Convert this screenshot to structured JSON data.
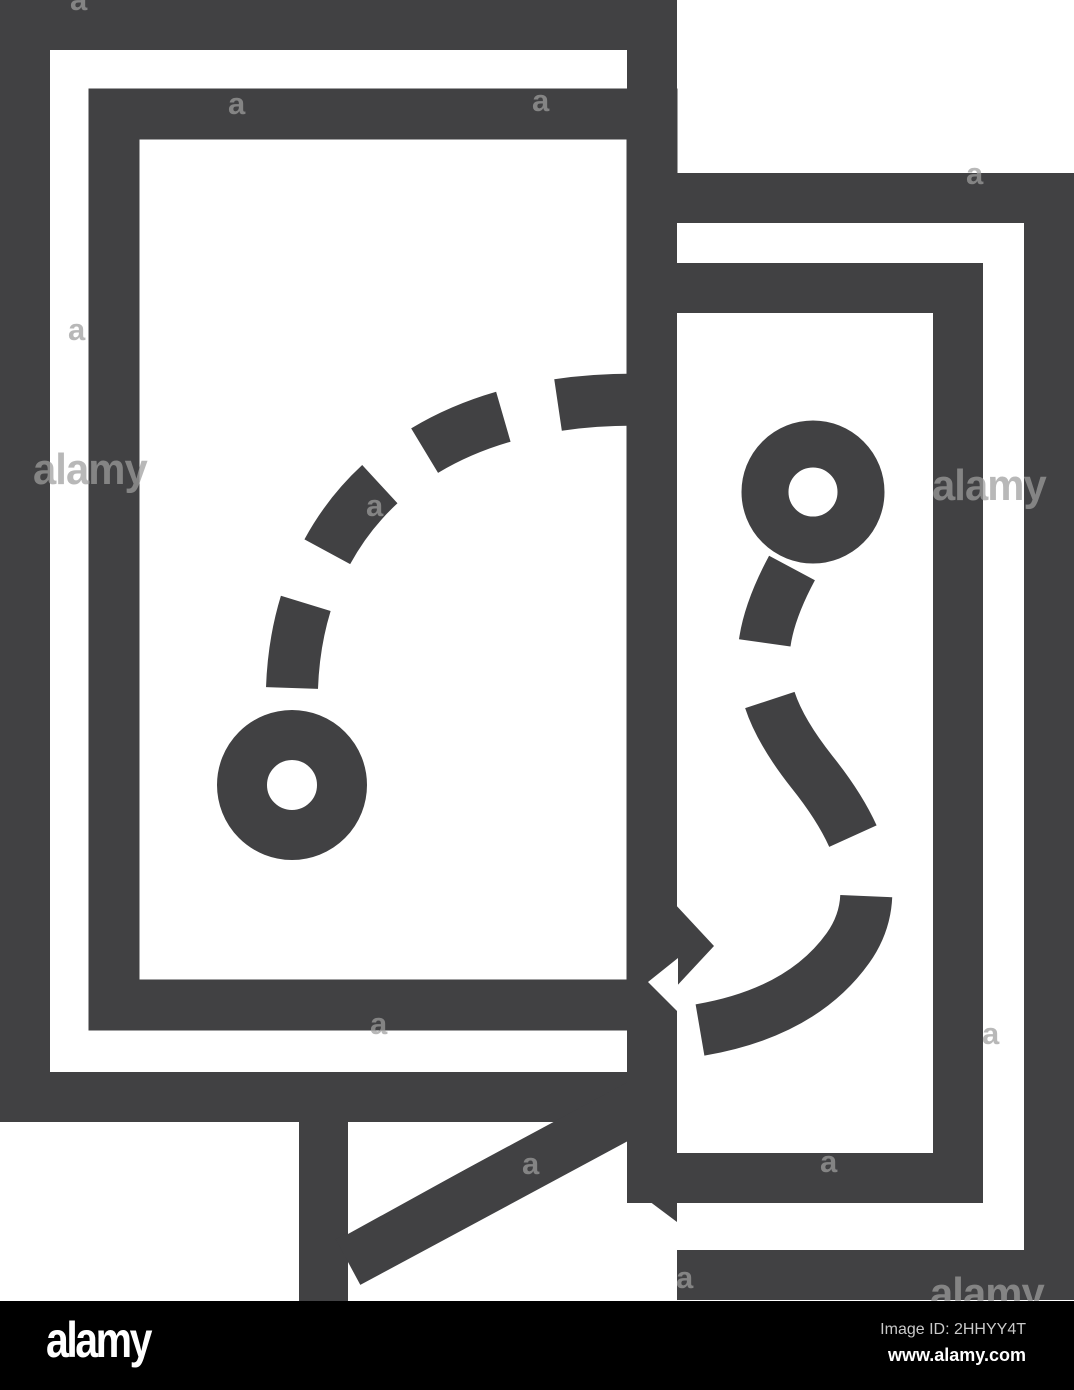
{
  "page": {
    "kind": "stock image preview with watermark",
    "background_color": "#ffffff"
  },
  "icon": {
    "name": "tactic-strategy-icon",
    "description": "Line icon of two overlapping boards with dashed route paths and ring start markers",
    "ink_color": "#414143"
  },
  "watermark": {
    "letter": "a",
    "word": "alamy",
    "color": "#9e9e9e"
  },
  "footer": {
    "background_color": "#000000",
    "logo_text": "alamy",
    "image_id_label": "Image ID: 2HHYY4T",
    "website_url": "www.alamy.com"
  }
}
